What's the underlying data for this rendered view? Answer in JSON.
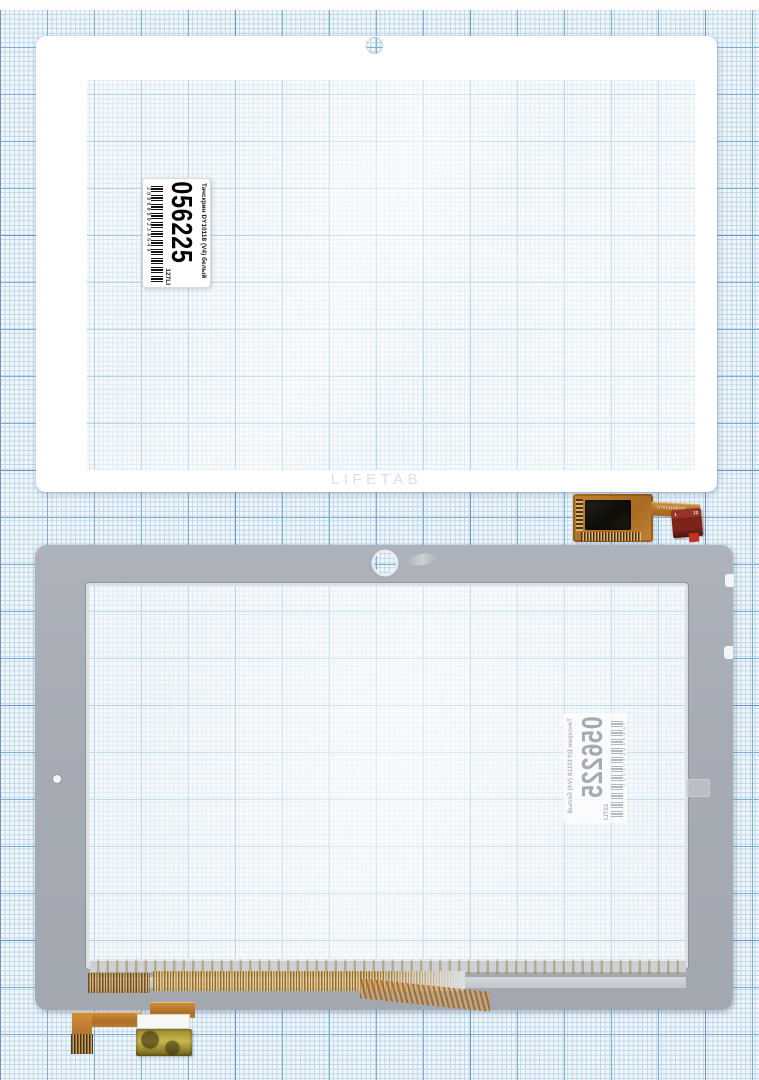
{
  "scene": {
    "type": "product-photo",
    "subject": "Tablet touchscreen digitizer shown front and back on millimeter graph paper"
  },
  "front_panel": {
    "brand": "LIFETAB"
  },
  "label": {
    "number": "056225",
    "title": "Тачскрин DY10118 (V4) белый",
    "suffix": "127LI",
    "barcode_digits": "2000000234649"
  },
  "front_flex": {
    "marking": "DY010118(V4)",
    "pin_first": "1",
    "pin_last": "12"
  },
  "colors": {
    "paper": "#f0f6fa",
    "grid_minor": "#bcd7e8",
    "grid_major": "#7fafd2",
    "grid_heavy": "#6d94c4",
    "panel_white": "#ffffff",
    "panel_gray": "#a9aeb7",
    "copper": "#bf7c31",
    "copper_dark": "#8a5a1e",
    "chip_black": "#17140e",
    "connector_maroon": "#7c241a",
    "gold": "#c7b14a"
  }
}
